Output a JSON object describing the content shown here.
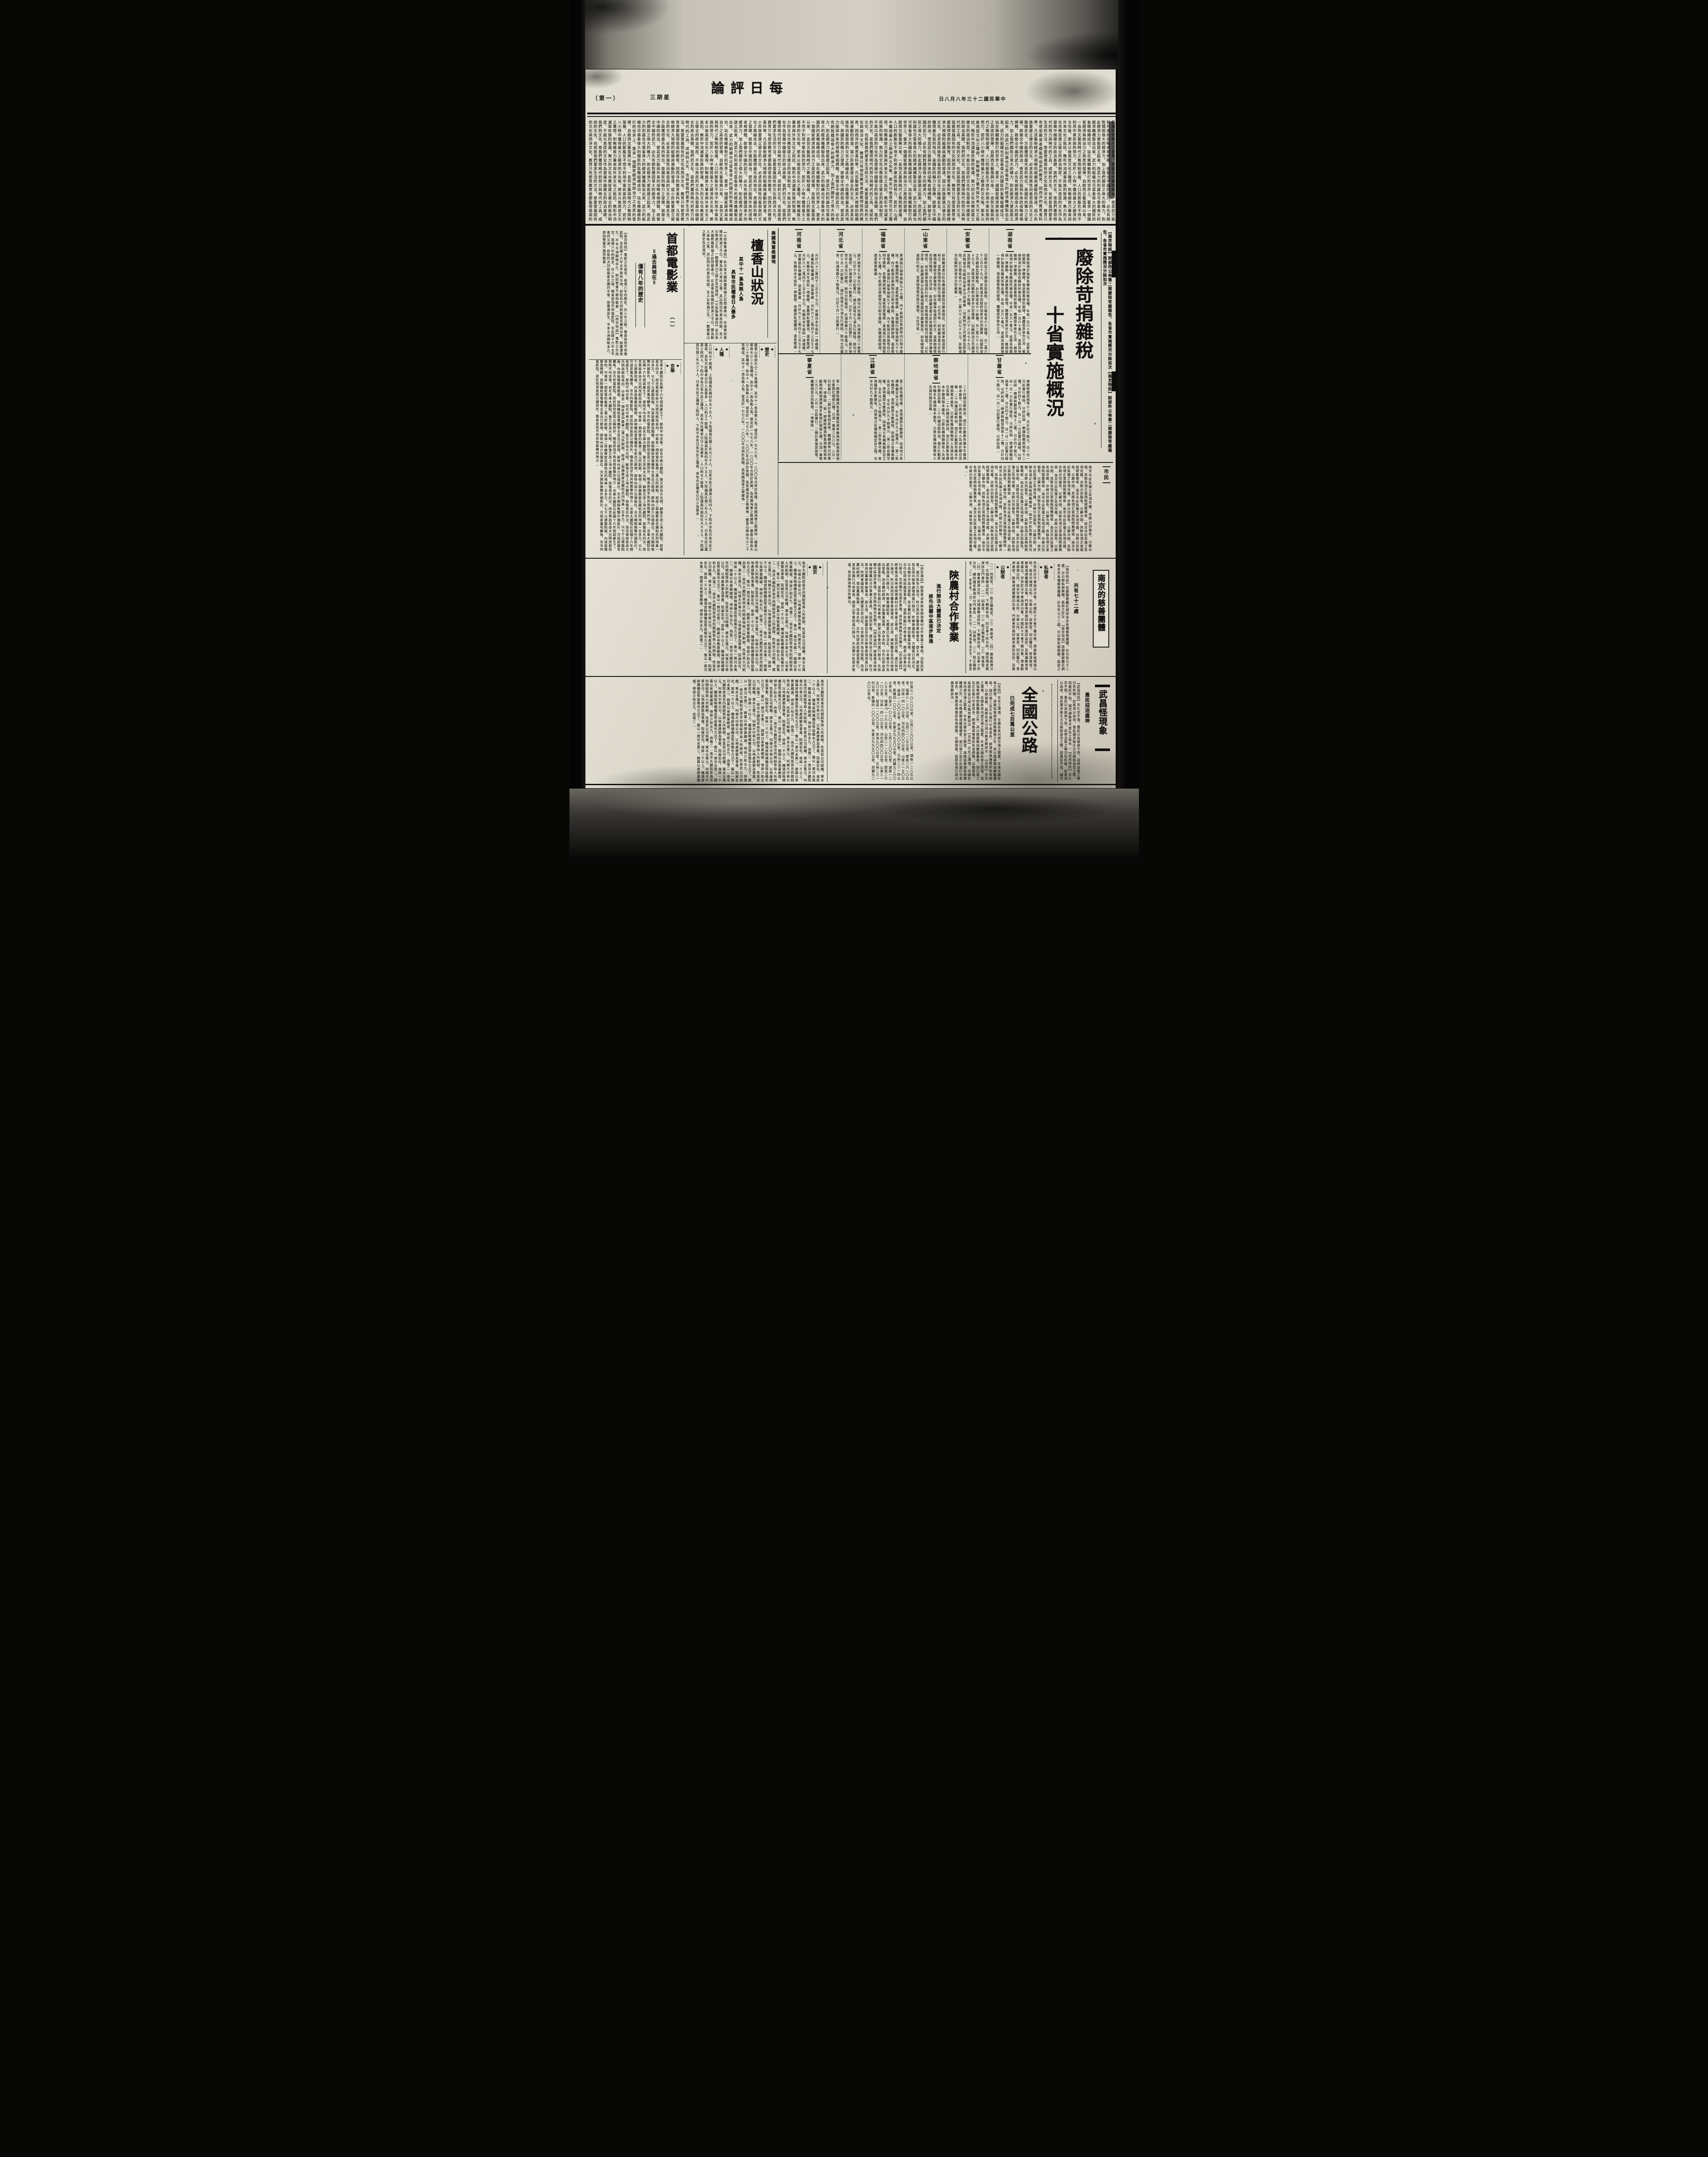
{
  "masthead": {
    "page_no": "（第一）",
    "weekday": "星期三",
    "title": "每日評論",
    "date": "中華民國二十三年八月八日"
  },
  "editorial": {
    "text": "是國民的魄力之發揮。欲健全中國的政治，使其武力能與外來的侵略者相搏戰，欲健全中國的武力，必先有絕對穩固偉大的經濟力，加上我們國民之偉大的魄力，則此經濟力便能建立起來，而武力的利器也可靠着偉大的經濟機構製造出來，武力的組織也可靠着偉大的國民的氣魄組織成功。站在幾關槍對打的世界上，要求一個國家經濟與政治力之高度的發揮，自歐西文藝復興以來，一直到文藝與時代之無限制發展，人口的膨脹在不得不利用中華民族的努力，若於八小時中獲得最大之經濟的文化後，那末以後高度文化之獲得，則無緣故力量來與外來文化之抵抗，無形中消滅華民族的智識，無力的文化也無從建立健全的政治制度，不能以高度的文化作為發展中國健全的政治基礎。我們的文化，是我們獲得時代的努力與時代的工具，成就的文化，也就是我們要求生活的方法，是要發展固有的文化與西洋文化，教育只有使受教育者都能得很高的教育，因西洋的教育重科學，凡百藝術經濟大規模的組織與運動的發達，弱小民族要建立健全的文化，必求其民族性向着很高的文化之路線走去，方能獲得最先進的地位。"
  },
  "tax_article": {
    "kicker": "【南京特訊】財部昨公佈第二期廢除苛雜報告，各省市實施概況分誌如次",
    "title_line1": "廢除苛捐雜稅",
    "title_line2": "十省實施概況",
    "sections": [
      {
        "name": "湖南省",
        "excerpt": "雜捐款項計抽收各縣前所徵各種，年收一百六十萬元，並將其他雜捐一律撤銷，漸逐察看情形辦理，團體禁革移作正用…"
      },
      {
        "name": "安徽省",
        "excerpt": "田賦附加之苛雜捐急即廢除，計已徵收者六十餘種，共二萬六千八百七十九元，其餘或非田賦附加者亦分別裁廢…"
      },
      {
        "name": "山東省",
        "excerpt": "財政廳派委分赴各縣視察廢除苛雜後情形，如有陽奉陰違即行糾正，並將辦理情形按月報部，以杜浮收…"
      },
      {
        "name": "福建省",
        "excerpt": "黃酒捐行捐等捐稅九十七種，內千船捐百貨捐等均已明令廢除，各縣遵照辦理，違者照章懲處…"
      },
      {
        "name": "河北省",
        "excerpt": "鴉片捐等廿七項先行廢除，餘均分別裁併，計減收銀六十餘萬元，已於十月一日起實行…"
      },
      {
        "name": "河南省",
        "excerpt": "共計六十二萬四千三百五十七元，各縣自本年度起一律裁廢，並嚴禁私擅攤派，違者懲處…"
      },
      {
        "name": "甘肅省",
        "excerpt": "磨課稅驗契捐等十二種，月計四千餘元，自一月一日起實行廢除，以紓民困…"
      },
      {
        "name": "察哈爾省",
        "excerpt": "二十四種田賦附加，現正計劃將各縣本年雜捐根本裁免，已將各縣捐額徵收入及減計細目造報…"
      },
      {
        "name": "江蘇省",
        "excerpt": "第二批各縣苛雜，查得擬即全數廢除，因係地方各種無關宏旨之捐，全年共計九十餘萬元…"
      },
      {
        "name": "寧夏省",
        "excerpt": "第一期廢除糧捐牧畜捐驗契捐車駛捐地畝捐煙燈捐羊隻捐扛頭捐九種，月須一萬零三九八元，八月一日起實行，二期計善後罰款等，繼續調查分別整理，一律廢除…"
      },
      {
        "name": "市民",
        "excerpt": "南京市民負擔之各項苛雜，亦經分別豁免，以蘇市困，其餘各項正當捐稅照舊徵收…"
      }
    ]
  },
  "honolulu_article": {
    "kicker": "美國海軍根據地",
    "title": "檀香山狀況",
    "subhead1": "其中十一島為無人島",
    "subhead2": "具有市民權者日人最多",
    "lead": "【火奴魯魯通訊】此次美大總統羅斯福之訪問檀香山，在遠東局面微妙莫測之今日，實為耐人尋味之事，其訪問目的果若何耶，吾人在推測之先，一觀檀香山之歷史及其現狀。",
    "sections": [
      {
        "name": "歷史",
        "excerpt": "檀香山係由大小二十島構成，其中十一島為無人島，發見於一七七八年，一八〇〇年合併於美國，為美國海軍之根據地…"
      },
      {
        "name": "人種",
        "excerpt": "人口約五十餘萬，上院議員任期四年凡十五人，下院議員任期二年凡三十人，日系市民之議員上院四人，下院中亦有日系市民之議員，具有市民權者以日人為最多…"
      }
    ]
  },
  "film_article": {
    "title": "首都電影業",
    "part": "（一）",
    "subhead1": "＝過去與現在＝",
    "subhead2": "僅有八年的歷史",
    "lead": "【南京特訊】電影之在南京，祇僅八年的歷史，在八年之前，簡直是找不到電影院，至民國十六年太平巷的五洲，府街的大同和蔡家花園的中華，始應運而生，不幸五洲開映未久，即因營業不振而歇業…",
    "sections": [
      {
        "name": "京華",
        "excerpt": "京華大戲院在民國十六年間就產生了，那時不叫京華，初名中華大戲院，後又改為大光明，嗣後又改上海大戲院，前後易名四次，而京華就是由大光明改組而來的，中華是一個姓雷的集資二萬元所創辦，租得二郎廟蔡家花園柏氏的地基一百多方，以七千元建築院屋，內容設備都很簡陋，放映機和發電機等全是自己經理，那時內容六百個座位，天天開映無聲外國影片，可說是鳳毛麟角，京市的電影院，居民除却逛逛公園而外，簡直是找不到其他娛樂的地方…"
      },
      {
        "name": "南京",
        "excerpt": "南京大戲院是南京的閻紹等與人所創辦，性質是公司組織，資本五萬元，叫做大中華公司，以地產建築為事業，院屋宏化，容座一千以上，機場放映構機造等設備也方式了，像以一資司本萬二，開幕以來營業頗盛，得容少和去九，由電二…"
      }
    ]
  },
  "shaanxi_article": {
    "title": "陝農村合作事業",
    "subhead1": "進行辦法大體業已決定",
    "subhead2": "將先由關中區逐步推進",
    "lead": "【西安通訊】經委會派來陝省辦理農村合作事業之專員，自抵西安後，連日與各方接洽，昨日與西京籌委會秘書長、邵主席、建設廳長及西北辦事處復商進行辦法，昨開會議結果，大體業已有決定，以金融合作為出發點，改良農村經濟，增加農業投資，改良水利，合作社即由該處逐漸推行，並與各銀行代表會商，劉景山等會同進行辦法，先由關中區逐步推進，再及陝南陝北各縣云。"
  },
  "charity_article": {
    "title": "南京的慈善團體",
    "subhead": "共有七十二處",
    "lead": "【南京特訊】首都警察廳近調查本京各種慈善團體，計共有七十二處，分公辦私辦兩類，茲誌之於次…",
    "groups": [
      {
        "name": "私辦者",
        "excerpt": "世界紅卍字會南京分會，中國紅十字會下關分會，理善勸戒煙酒公所，南京市掩埋公所，中華公所，崇善堂，同志醫社，普濟善堂，慈善戒煙團體同志會，門慈善堂施材施米施診送診，及救護教育等事業云。"
      },
      {
        "name": "公辦者",
        "excerpt": "（一）同善堂，（二）租乏積善堂，（三）普善堂，（四）廣善救濟分所，北城施樂送診所，下關慈幼局，同志會十所分所，總所殘老教濟診分門會所…"
      }
    ]
  },
  "highway_article": {
    "title": "全國公路",
    "subhead": "已完成七百萬公里",
    "lead": "【京訊】文化之溝通，全國各省均感交通之需要，年來全國各省之開發，道路協會調查修築鐵路之外，其公路建築成績最優者，現已竣工及正在進行中者甚多，經濟委員會督促各省趕築，以期發展，茲將各省已成公路里數誌次…",
    "excerpt": "計浙江一〇八〇公里，江西三三〇〇公里，湖南一二八五公里，福建八一三六公里，山西二一二五公里，雲南二六一〇公里，河南一四一〇公里，河北四四〇〇公里，山東三一五〇公里，綏遠一二〇〇公里，青海九〇〇公里，吉林二三一四公里，新疆四一〇〇公里，外蒙古九九五〇公里，西藏九二六〇公里云。"
  },
  "wuchang_article": {
    "title": "武昌怪現象",
    "subhead": "愚民迎送瘟神",
    "lead": "【武昌特訊】天久旱不雨，愚民以為瘟神下界，迎神送瘟之舉日有所聞，記者深以為奇，當此講求衛生方法破除迷信之際，而愚民不知，誠可謂教育不普及之故也…"
  }
}
